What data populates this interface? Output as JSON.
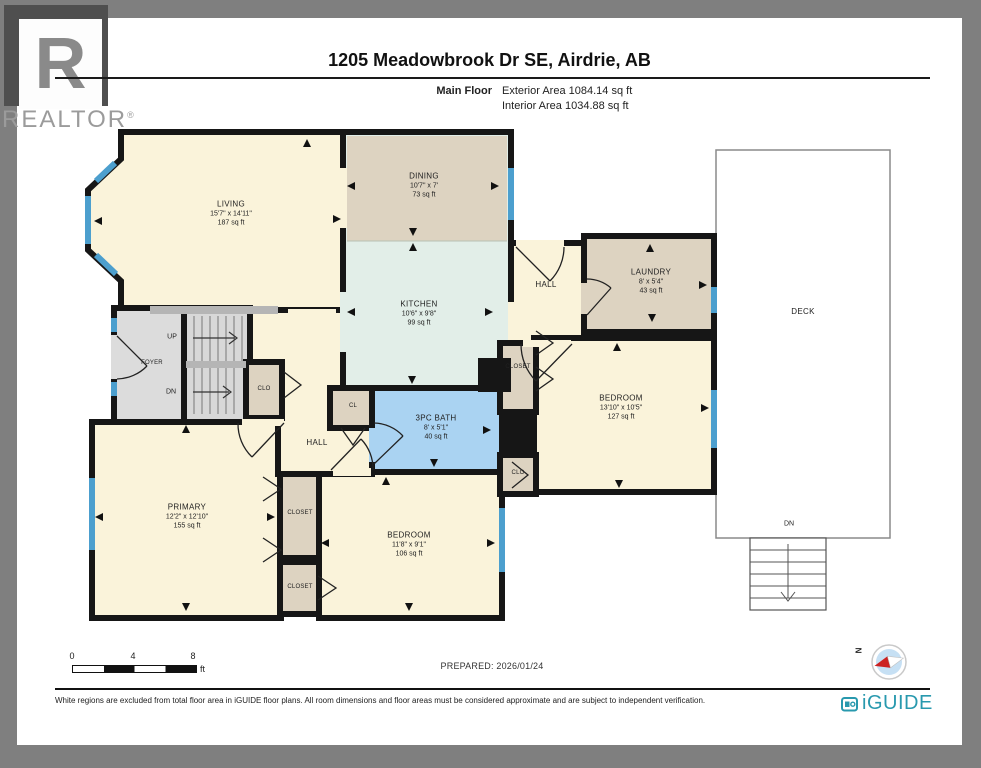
{
  "header": {
    "realtor_letter": "R",
    "realtor_name": "REALTOR",
    "realtor_reg": "®",
    "title": "1205 Meadowbrook Dr SE, Airdrie, AB",
    "floor_label": "Main Floor",
    "exterior_area": "Exterior Area 1084.14 sq ft",
    "interior_area": "Interior Area 1034.88 sq ft"
  },
  "rooms": {
    "living": {
      "name": "LIVING",
      "dims": "15'7\" x 14'11\"",
      "area": "187 sq ft"
    },
    "dining": {
      "name": "DINING",
      "dims": "10'7\" x 7'",
      "area": "73 sq ft"
    },
    "kitchen": {
      "name": "KITCHEN",
      "dims": "10'6\" x 9'8\"",
      "area": "99 sq ft"
    },
    "hall_upper": {
      "name": "HALL"
    },
    "laundry": {
      "name": "LAUNDRY",
      "dims": "8' x 5'4\"",
      "area": "43 sq ft"
    },
    "deck": {
      "name": "DECK",
      "down": "DN"
    },
    "bedroom_right": {
      "name": "BEDROOM",
      "dims": "13'10\" x 10'5\"",
      "area": "127 sq ft"
    },
    "closet_right": {
      "name": "CLOSET"
    },
    "clo_right": {
      "name": "CLO"
    },
    "bath": {
      "name": "3PC BATH",
      "dims": "8' x 5'1\"",
      "area": "40 sq ft"
    },
    "cl": {
      "name": "CL"
    },
    "hall_center": {
      "name": "HALL"
    },
    "foyer": {
      "name": "FOYER"
    },
    "stairs": {
      "up": "UP",
      "down": "DN"
    },
    "clo_stairs": {
      "name": "CLO"
    },
    "primary": {
      "name": "PRIMARY",
      "dims": "12'2\" x 12'10\"",
      "area": "155 sq ft"
    },
    "closet_primary_upper": {
      "name": "CLOSET"
    },
    "closet_primary_lower": {
      "name": "CLOSET"
    },
    "bedroom_bottom": {
      "name": "BEDROOM",
      "dims": "11'8\" x 9'1\"",
      "area": "106 sq ft"
    }
  },
  "scalebar": {
    "t0": "0",
    "t4": "4",
    "t8": "8",
    "unit": "ft"
  },
  "prepared": "PREPARED: 2026/01/24",
  "compass": {
    "north": "N"
  },
  "footer": {
    "disclaimer": "White regions are excluded from total floor area in iGUIDE floor plans. All room dimensions and floor areas must be considered approximate and are subject to independent verification.",
    "brand": "iGUIDE"
  },
  "colors": {
    "wall": "#161616",
    "room_cream": "#FAF3DA",
    "room_tan": "#DDD3C1",
    "kitchen_mint": "#E2EEE8",
    "bath_blue": "#AAD3F2",
    "window_blue": "#4C9FCE",
    "stairs_gray": "#D8D8D8",
    "frame_gray": "#7F7F7F",
    "brand_teal": "#2899AE",
    "compass_red": "#CC2222"
  }
}
